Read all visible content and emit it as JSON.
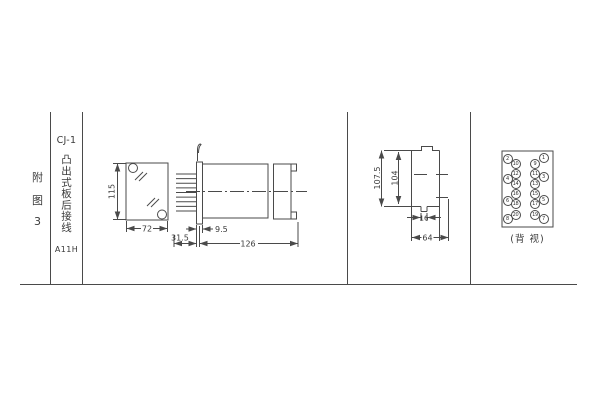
{
  "colors": {
    "line": "#4a4a4a",
    "text": "#3a3a3a",
    "background": "#ffffff"
  },
  "sidebar": {
    "figure_chars": [
      "附",
      "图",
      "3"
    ],
    "model": "CJ-1",
    "wiring_type": "凸出式板后接线",
    "code": "A11H"
  },
  "front_view": {
    "dim_height": "115",
    "dim_width": "72"
  },
  "side_view": {
    "dim_pin_length": "31.5",
    "dim_panel": "9.5",
    "dim_length": "126"
  },
  "profile_view": {
    "dim_overall": "107.5",
    "dim_inner": "104",
    "dim_tab": "16",
    "dim_width": "64"
  },
  "rear_view": {
    "caption": "(背 视)",
    "pins": [
      "1",
      "2",
      "3",
      "4",
      "5",
      "6",
      "7",
      "8",
      "9",
      "10",
      "11",
      "12",
      "13",
      "14",
      "15",
      "16",
      "17",
      "18",
      "19",
      "20"
    ]
  }
}
